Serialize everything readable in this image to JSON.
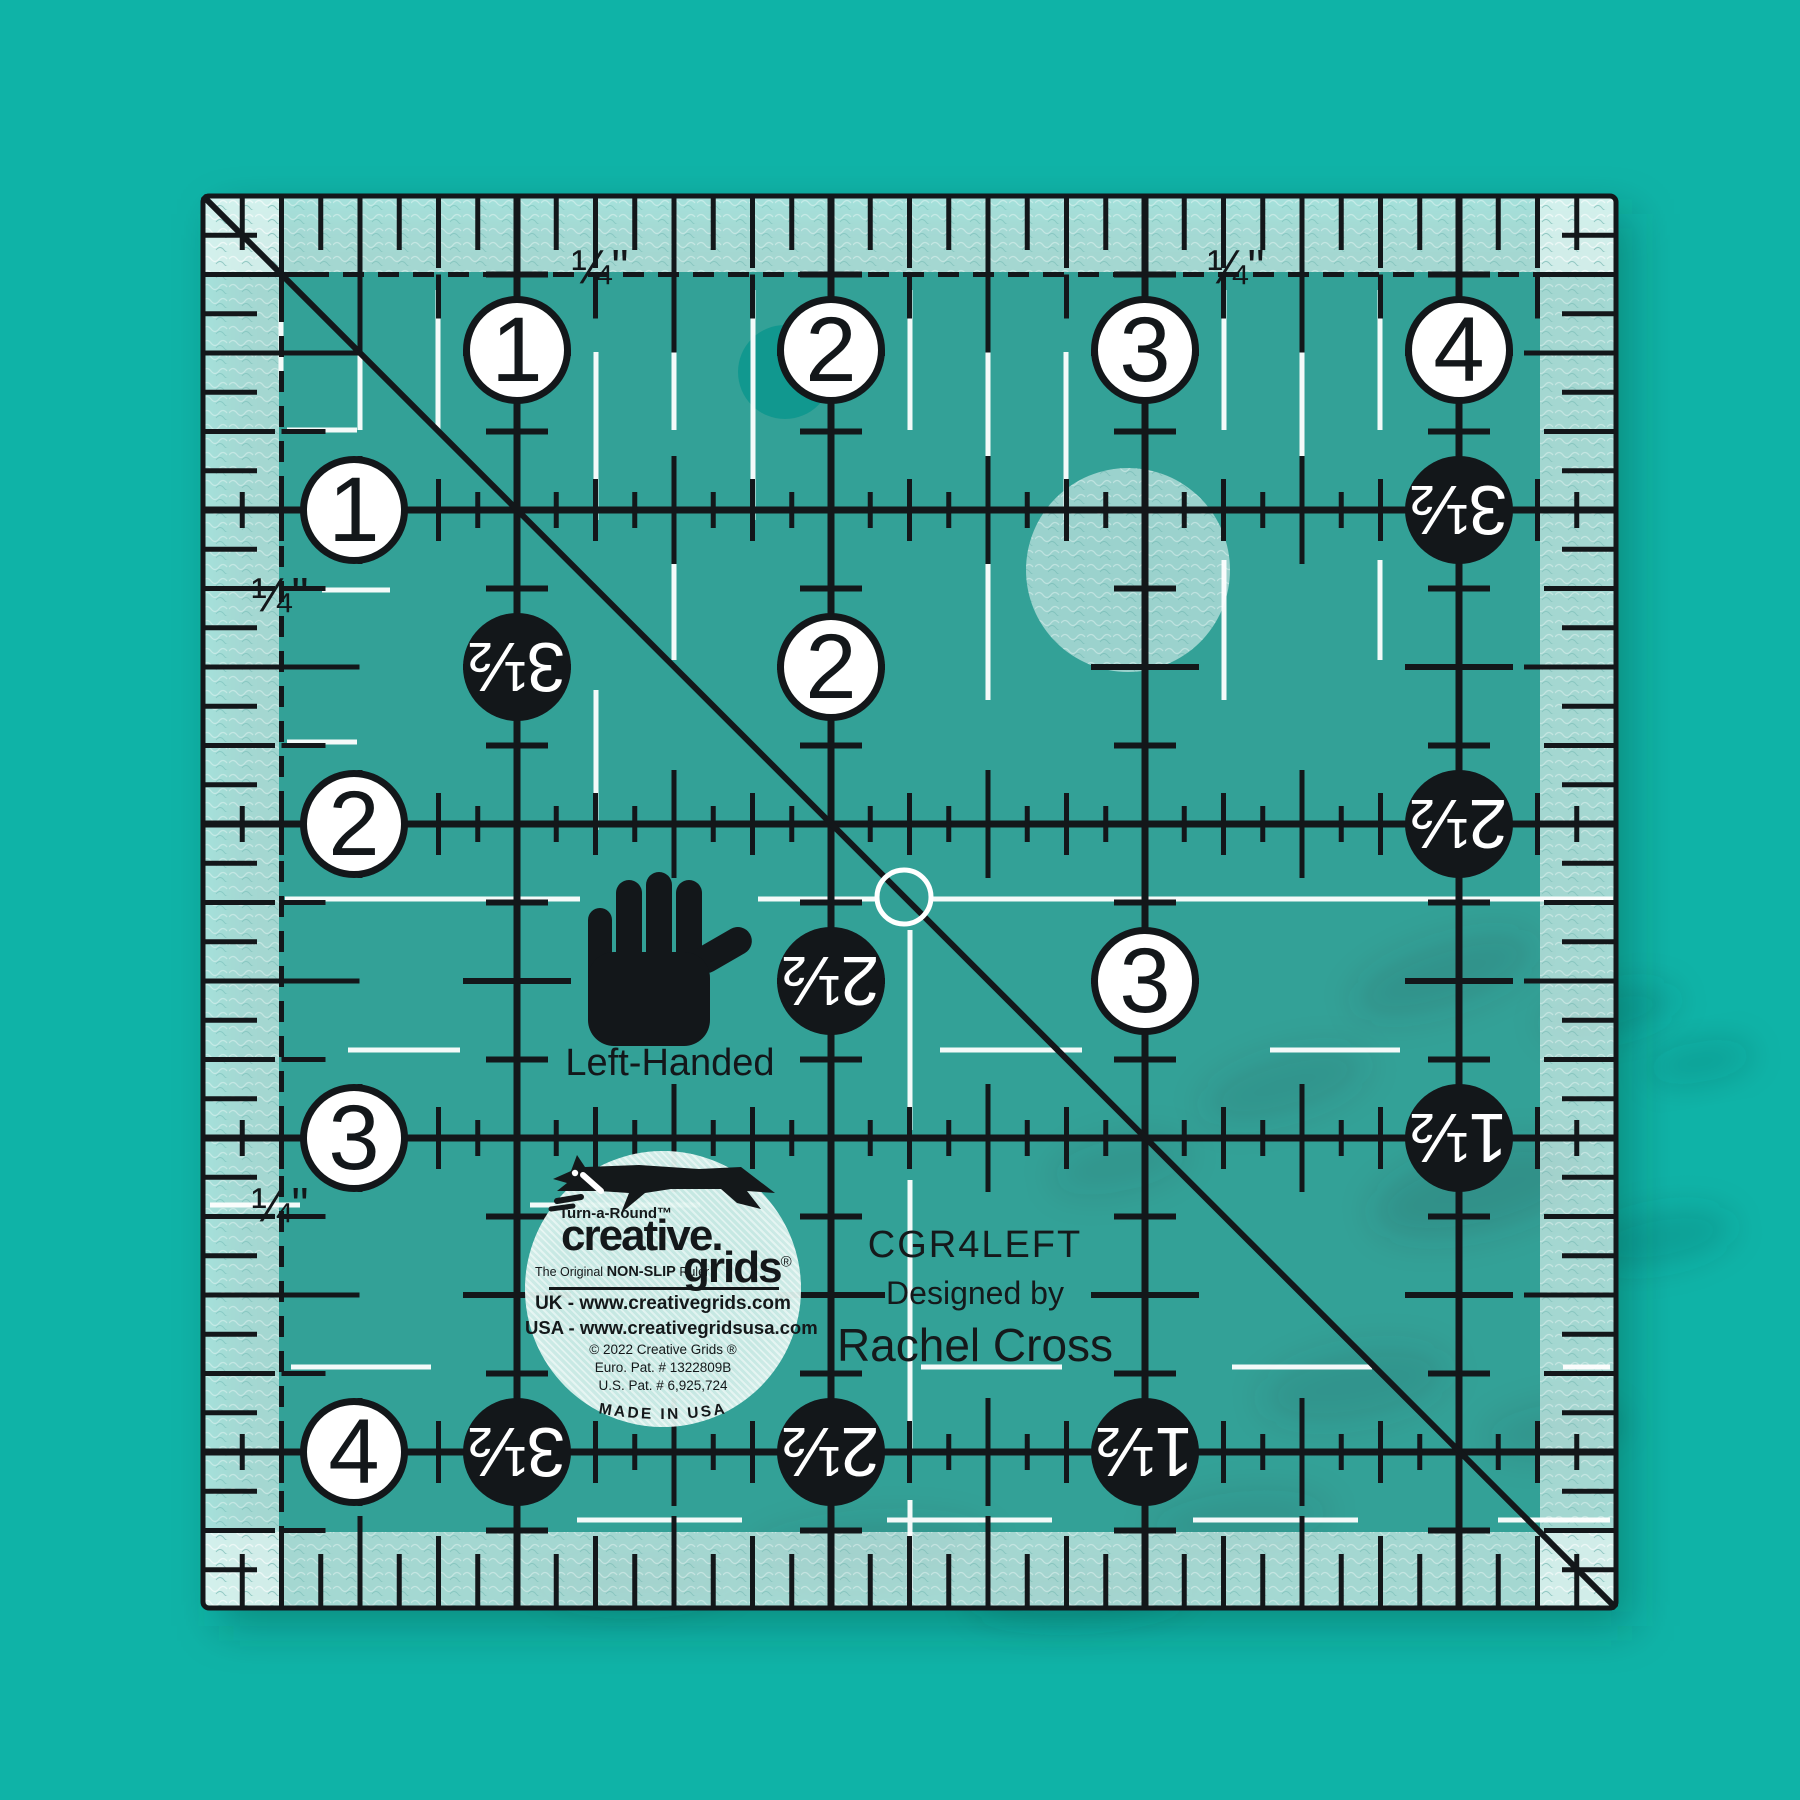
{
  "scene": {
    "background_color": "#0fb3a7",
    "ink_color": "#13171a",
    "white_mark_color": "#ffffff",
    "ruler_tint": "rgba(255,255,255,0.17)",
    "band_tint": "rgba(240,252,249,0.6)"
  },
  "labels": {
    "quarter_inch": "¼\"",
    "left_handed": "Left-Handed"
  },
  "product_text": {
    "model": "CGR4LEFT",
    "designed_by": "Designed by",
    "designer": "Rachel Cross"
  },
  "logo": {
    "turn_a_round": "Turn-a-Round™",
    "brand_top": "creative.",
    "brand_bottom": "grids",
    "registered_mark": "®",
    "tagline_prefix": "The Original ",
    "tagline_emphasis": "NON-SLIP",
    "tagline_suffix": " Ruler",
    "uk_site": "UK - www.creativegrids.com",
    "usa_site": "USA - www.creativegridsusa.com",
    "copyright": "© 2022  Creative Grids ®",
    "euro_patent": "Euro. Pat. # 1322809B",
    "us_patent": "U.S. Pat. # 6,925,724",
    "made_in": "MADE IN USA"
  },
  "ruler": {
    "geometry": {
      "left": 203,
      "top": 196,
      "width": 1413,
      "height": 1412,
      "inch_px": 314
    },
    "inch_circles": [
      {
        "x": 517,
        "y": 350,
        "label": "1"
      },
      {
        "x": 831,
        "y": 350,
        "label": "2"
      },
      {
        "x": 1145,
        "y": 350,
        "label": "3"
      },
      {
        "x": 1459,
        "y": 350,
        "label": "4"
      },
      {
        "x": 354,
        "y": 510,
        "label": "1"
      },
      {
        "x": 354,
        "y": 824,
        "label": "2"
      },
      {
        "x": 354,
        "y": 1138,
        "label": "3"
      },
      {
        "x": 354,
        "y": 1452,
        "label": "4"
      },
      {
        "x": 831,
        "y": 667,
        "label": "2"
      },
      {
        "x": 1145,
        "y": 981,
        "label": "3"
      }
    ],
    "half_inch_circles": [
      {
        "x": 517,
        "y": 667,
        "label": "3½"
      },
      {
        "x": 831,
        "y": 981,
        "label": "2½"
      },
      {
        "x": 1459,
        "y": 510,
        "label": "3½"
      },
      {
        "x": 1459,
        "y": 824,
        "label": "2½"
      },
      {
        "x": 1459,
        "y": 1138,
        "label": "1½"
      },
      {
        "x": 517,
        "y": 1452,
        "label": "3½"
      },
      {
        "x": 831,
        "y": 1452,
        "label": "2½"
      },
      {
        "x": 1145,
        "y": 1452,
        "label": "1½"
      }
    ],
    "quarter_labels": [
      {
        "x": 600,
        "y": 268
      },
      {
        "x": 1236,
        "y": 268
      },
      {
        "x": 280,
        "y": 596
      },
      {
        "x": 280,
        "y": 1206
      }
    ],
    "white_marks": {
      "verticals": [
        {
          "x": 78,
          "segments": [
            [
              104,
              184
            ]
          ]
        },
        {
          "x": 157,
          "segments": [
            [
              104,
              234
            ]
          ]
        },
        {
          "x": 235,
          "segments": [
            [
              94,
              234
            ]
          ]
        },
        {
          "x": 393,
          "segments": [
            [
              156,
              324
            ],
            [
              494,
              634
            ]
          ]
        },
        {
          "x": 471,
          "segments": [
            [
              94,
              234
            ],
            [
              364,
              464
            ]
          ]
        },
        {
          "x": 550,
          "segments": [
            [
              94,
              324
            ]
          ]
        },
        {
          "x": 707,
          "segments": [
            [
              94,
              234
            ],
            [
              734,
              934
            ],
            [
              984,
              1254
            ],
            [
              1304,
              1394
            ]
          ]
        },
        {
          "x": 785,
          "segments": [
            [
              94,
              324
            ],
            [
              364,
              504
            ]
          ]
        },
        {
          "x": 863,
          "segments": [
            [
              156,
              324
            ]
          ]
        },
        {
          "x": 1021,
          "segments": [
            [
              94,
              234
            ],
            [
              364,
              504
            ]
          ]
        },
        {
          "x": 1099,
          "segments": [
            [
              94,
              324
            ]
          ]
        },
        {
          "x": 1177,
          "segments": [
            [
              94,
              234
            ],
            [
              364,
              464
            ]
          ]
        }
      ],
      "horizontals": [
        {
          "y": 234,
          "segments": [
            [
              84,
              154
            ]
          ]
        },
        {
          "y": 394,
          "segments": [
            [
              119,
              187
            ]
          ]
        },
        {
          "y": 546,
          "segments": [
            [
              84,
              154
            ]
          ]
        },
        {
          "y": 703,
          "segments": [
            [
              82,
              377
            ],
            [
              555,
              673
            ],
            [
              727,
              1410
            ]
          ]
        },
        {
          "y": 854,
          "segments": [
            [
              145,
              257
            ],
            [
              737,
              879
            ],
            [
              1067,
              1197
            ]
          ]
        },
        {
          "y": 1009,
          "segments": [
            [
              7,
              97
            ],
            [
              327,
              497
            ]
          ]
        },
        {
          "y": 1171,
          "segments": [
            [
              88,
              228
            ],
            [
              718,
              859
            ],
            [
              1029,
              1169
            ],
            [
              1360,
              1407
            ]
          ]
        },
        {
          "y": 1324,
          "segments": [
            [
              374,
              539
            ],
            [
              684,
              849
            ],
            [
              990,
              1155
            ],
            [
              1295,
              1407
            ]
          ]
        }
      ]
    }
  }
}
